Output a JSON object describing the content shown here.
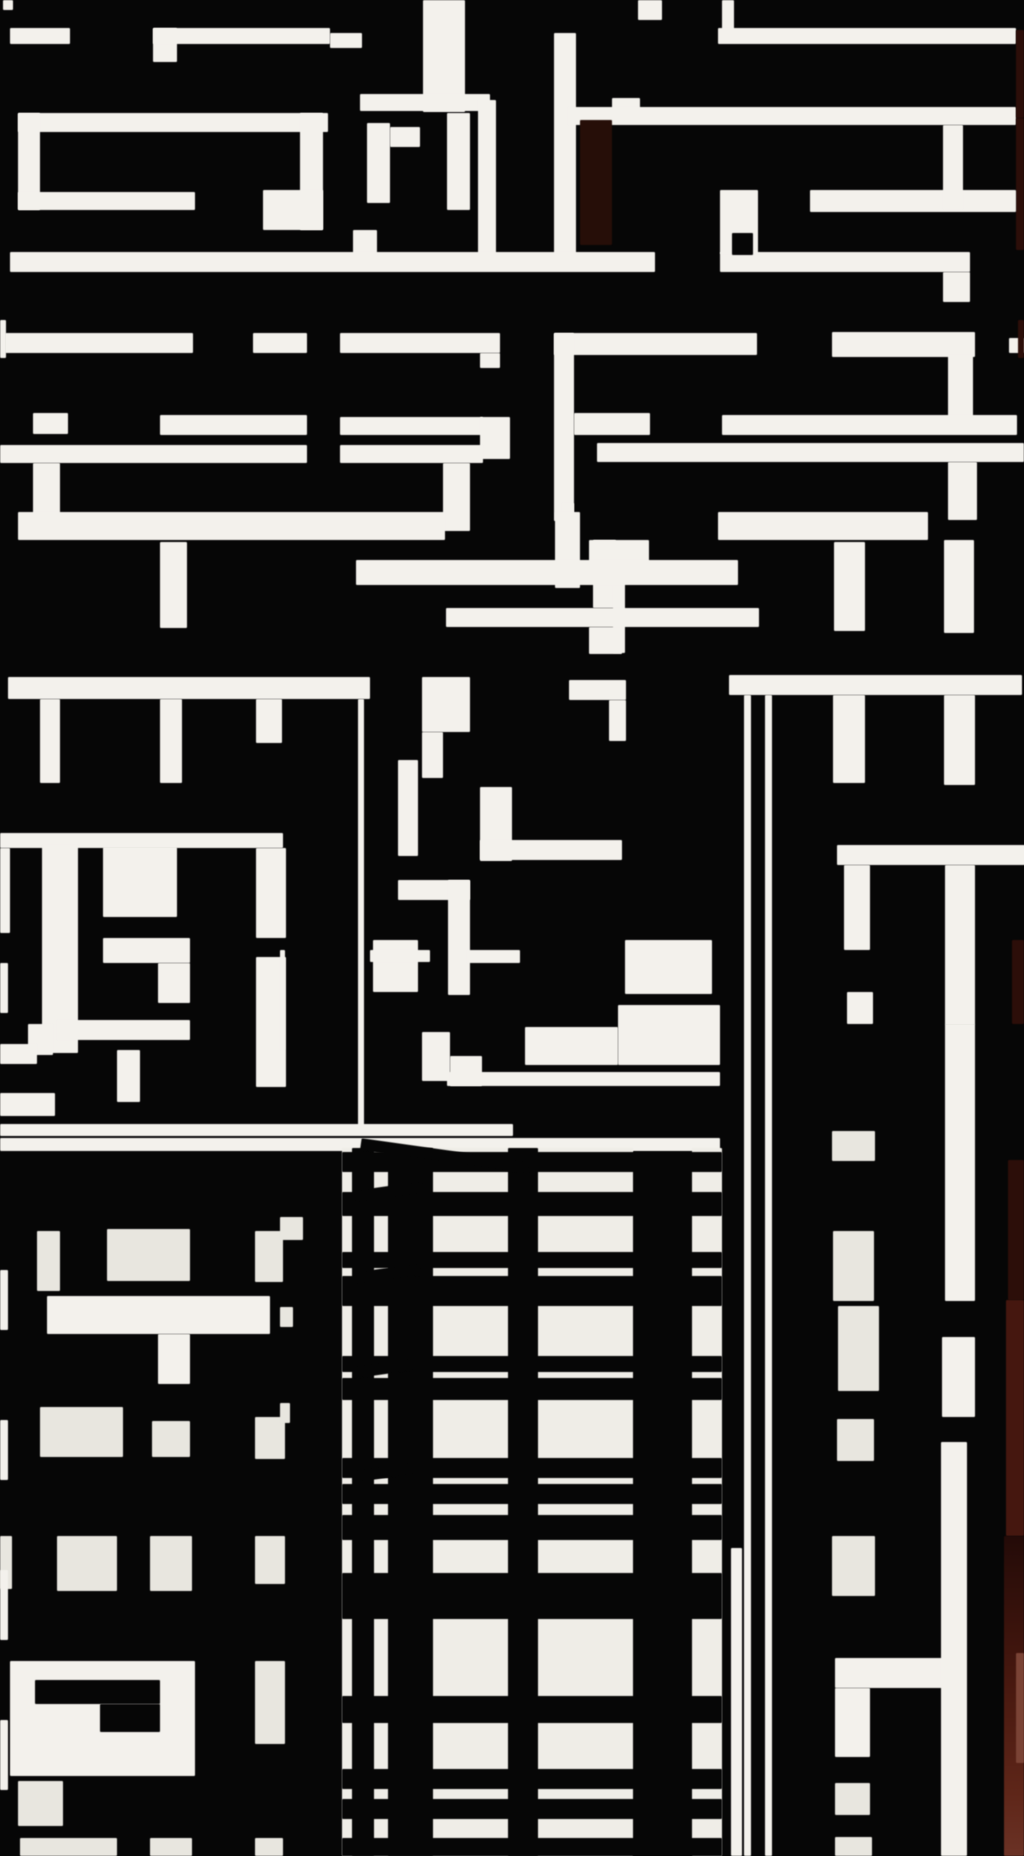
{
  "artwork": {
    "kind": "abstract-monochrome-collage",
    "canvas": {
      "width": 1024,
      "height": 1856
    },
    "palette": {
      "background": "#060606",
      "bar_white": "#f3f1ec",
      "window_white": "#e8e6df",
      "panel_white": "#efede7",
      "maroon": "#260e08",
      "rust_dark": "#2c0e09",
      "rust_mid": "#45170f",
      "rust_bright": "#7a4335"
    },
    "shapes": [
      [
        3,
        0,
        10,
        10,
        "w"
      ],
      [
        10,
        28,
        60,
        16,
        "w"
      ],
      [
        153,
        28,
        24,
        34,
        "w"
      ],
      [
        153,
        28,
        177,
        16,
        "w"
      ],
      [
        330,
        33,
        32,
        15,
        "w"
      ],
      [
        423,
        0,
        42,
        112,
        "w"
      ],
      [
        360,
        94,
        130,
        17,
        "w"
      ],
      [
        554,
        33,
        22,
        222,
        "w"
      ],
      [
        638,
        0,
        24,
        20,
        "w"
      ],
      [
        722,
        0,
        12,
        40,
        "w"
      ],
      [
        718,
        28,
        298,
        16,
        "w"
      ],
      [
        612,
        98,
        28,
        18,
        "w"
      ],
      [
        568,
        107,
        448,
        18,
        "w"
      ],
      [
        478,
        100,
        18,
        160,
        "w"
      ],
      [
        580,
        120,
        32,
        125,
        "m"
      ],
      [
        1016,
        30,
        8,
        88,
        "r1"
      ],
      [
        1016,
        118,
        8,
        132,
        "r1"
      ],
      [
        18,
        113,
        310,
        19,
        "w"
      ],
      [
        18,
        113,
        22,
        97,
        "w"
      ],
      [
        18,
        192,
        177,
        18,
        "w"
      ],
      [
        300,
        113,
        23,
        117,
        "w"
      ],
      [
        263,
        190,
        60,
        40,
        "w"
      ],
      [
        367,
        123,
        23,
        80,
        "w"
      ],
      [
        390,
        127,
        30,
        20,
        "w"
      ],
      [
        447,
        113,
        23,
        97,
        "w"
      ],
      [
        353,
        230,
        24,
        24,
        "w"
      ],
      [
        10,
        252,
        645,
        20,
        "w"
      ],
      [
        720,
        252,
        250,
        20,
        "w"
      ],
      [
        720,
        190,
        38,
        64,
        "w"
      ],
      [
        732,
        233,
        21,
        22,
        "k"
      ],
      [
        810,
        190,
        206,
        22,
        "w"
      ],
      [
        943,
        125,
        20,
        84,
        "w"
      ],
      [
        943,
        272,
        27,
        30,
        "w"
      ],
      [
        0,
        320,
        6,
        38,
        "w"
      ],
      [
        5,
        333,
        188,
        20,
        "w"
      ],
      [
        253,
        333,
        54,
        20,
        "w"
      ],
      [
        340,
        333,
        160,
        20,
        "w"
      ],
      [
        480,
        353,
        20,
        15,
        "w"
      ],
      [
        554,
        333,
        203,
        22,
        "w"
      ],
      [
        554,
        333,
        20,
        188,
        "w"
      ],
      [
        832,
        332,
        143,
        25,
        "w"
      ],
      [
        948,
        355,
        25,
        62,
        "w"
      ],
      [
        1009,
        338,
        15,
        15,
        "w"
      ],
      [
        1018,
        320,
        6,
        38,
        "r1"
      ],
      [
        33,
        413,
        35,
        21,
        "w"
      ],
      [
        160,
        415,
        147,
        20,
        "w"
      ],
      [
        340,
        417,
        143,
        18,
        "w"
      ],
      [
        480,
        417,
        30,
        42,
        "w"
      ],
      [
        574,
        413,
        76,
        22,
        "w"
      ],
      [
        722,
        415,
        295,
        20,
        "w"
      ],
      [
        0,
        445,
        307,
        18,
        "w"
      ],
      [
        340,
        445,
        143,
        18,
        "w"
      ],
      [
        597,
        443,
        427,
        19,
        "w"
      ],
      [
        33,
        463,
        27,
        58,
        "w"
      ],
      [
        443,
        463,
        27,
        68,
        "w"
      ],
      [
        948,
        462,
        29,
        58,
        "w"
      ],
      [
        562,
        503,
        12,
        18,
        "w"
      ],
      [
        18,
        512,
        427,
        28,
        "w"
      ],
      [
        718,
        512,
        210,
        28,
        "w"
      ],
      [
        555,
        512,
        25,
        76,
        "w"
      ],
      [
        593,
        540,
        23,
        68,
        "w"
      ],
      [
        589,
        540,
        60,
        28,
        "w"
      ],
      [
        613,
        569,
        12,
        84,
        "w"
      ],
      [
        589,
        627,
        33,
        27,
        "w"
      ],
      [
        356,
        560,
        382,
        25,
        "w"
      ],
      [
        160,
        542,
        27,
        86,
        "w"
      ],
      [
        446,
        608,
        313,
        19,
        "w"
      ],
      [
        834,
        542,
        31,
        89,
        "w"
      ],
      [
        944,
        540,
        30,
        93,
        "w"
      ],
      [
        8,
        677,
        362,
        22,
        "w"
      ],
      [
        422,
        677,
        48,
        55,
        "w"
      ],
      [
        569,
        680,
        57,
        20,
        "w"
      ],
      [
        729,
        675,
        293,
        20,
        "w"
      ],
      [
        40,
        699,
        20,
        84,
        "w"
      ],
      [
        160,
        699,
        22,
        84,
        "w"
      ],
      [
        256,
        699,
        26,
        44,
        "w"
      ],
      [
        422,
        732,
        21,
        46,
        "w"
      ],
      [
        609,
        700,
        17,
        41,
        "w"
      ],
      [
        833,
        695,
        32,
        88,
        "w"
      ],
      [
        944,
        695,
        31,
        90,
        "w"
      ],
      [
        358,
        699,
        6,
        433,
        "w"
      ],
      [
        744,
        695,
        7,
        1161,
        "w"
      ],
      [
        765,
        695,
        7,
        1161,
        "w"
      ],
      [
        398,
        760,
        20,
        96,
        "w"
      ],
      [
        398,
        880,
        72,
        20,
        "w"
      ],
      [
        448,
        880,
        22,
        115,
        "w"
      ],
      [
        373,
        940,
        45,
        52,
        "w"
      ],
      [
        480,
        787,
        32,
        74,
        "w"
      ],
      [
        0,
        833,
        283,
        15,
        "w"
      ],
      [
        480,
        840,
        142,
        20,
        "w"
      ],
      [
        837,
        845,
        188,
        20,
        "w"
      ],
      [
        0,
        848,
        10,
        85,
        "w"
      ],
      [
        42,
        845,
        36,
        208,
        "w"
      ],
      [
        103,
        847,
        74,
        70,
        "w"
      ],
      [
        103,
        938,
        87,
        25,
        "w"
      ],
      [
        158,
        963,
        32,
        40,
        "w"
      ],
      [
        57,
        1020,
        133,
        20,
        "w"
      ],
      [
        117,
        1050,
        23,
        52,
        "w"
      ],
      [
        0,
        963,
        8,
        50,
        "w"
      ],
      [
        256,
        848,
        30,
        90,
        "w"
      ],
      [
        256,
        957,
        30,
        130,
        "w"
      ],
      [
        844,
        865,
        26,
        85,
        "w"
      ],
      [
        847,
        992,
        26,
        32,
        "w"
      ],
      [
        945,
        865,
        30,
        160,
        "w"
      ],
      [
        625,
        940,
        87,
        54,
        "w"
      ],
      [
        370,
        950,
        60,
        12,
        "w"
      ],
      [
        467,
        950,
        53,
        13,
        "w"
      ],
      [
        618,
        1005,
        102,
        60,
        "w"
      ],
      [
        525,
        1027,
        93,
        38,
        "w"
      ],
      [
        447,
        1072,
        273,
        14,
        "w"
      ],
      [
        422,
        1032,
        28,
        49,
        "w"
      ],
      [
        450,
        1056,
        32,
        30,
        "w"
      ],
      [
        433,
        1140,
        200,
        12,
        "w"
      ],
      [
        28,
        1024,
        25,
        31,
        "w"
      ],
      [
        0,
        1044,
        37,
        20,
        "w"
      ],
      [
        0,
        1093,
        55,
        23,
        "w"
      ],
      [
        280,
        950,
        5,
        100,
        "w"
      ],
      [
        0,
        1124,
        513,
        12,
        "w"
      ],
      [
        0,
        1138,
        720,
        13,
        "w"
      ],
      [
        37,
        1231,
        23,
        60,
        "w2"
      ],
      [
        107,
        1229,
        83,
        52,
        "w2"
      ],
      [
        255,
        1231,
        28,
        51,
        "w2"
      ],
      [
        47,
        1296,
        223,
        38,
        "w"
      ],
      [
        158,
        1334,
        32,
        50,
        "w"
      ],
      [
        40,
        1407,
        83,
        50,
        "w2"
      ],
      [
        152,
        1421,
        38,
        36,
        "w2"
      ],
      [
        255,
        1417,
        30,
        42,
        "w2"
      ],
      [
        0,
        1536,
        12,
        53,
        "w2"
      ],
      [
        57,
        1536,
        60,
        55,
        "w2"
      ],
      [
        150,
        1536,
        42,
        55,
        "w2"
      ],
      [
        255,
        1536,
        30,
        48,
        "w2"
      ],
      [
        10,
        1661,
        185,
        115,
        "w"
      ],
      [
        35,
        1680,
        125,
        24,
        "k"
      ],
      [
        100,
        1704,
        60,
        28,
        "k"
      ],
      [
        255,
        1661,
        30,
        83,
        "w2"
      ],
      [
        18,
        1781,
        45,
        45,
        "w2"
      ],
      [
        20,
        1838,
        97,
        18,
        "w2"
      ],
      [
        150,
        1838,
        42,
        18,
        "w2"
      ],
      [
        255,
        1838,
        28,
        18,
        "w2"
      ],
      [
        0,
        1270,
        8,
        60,
        "w"
      ],
      [
        0,
        1420,
        8,
        60,
        "w"
      ],
      [
        0,
        1570,
        8,
        70,
        "w"
      ],
      [
        0,
        1720,
        8,
        70,
        "w"
      ],
      [
        280,
        1217,
        23,
        23,
        "w2"
      ],
      [
        280,
        1307,
        13,
        20,
        "w2"
      ],
      [
        280,
        1403,
        10,
        20,
        "w2"
      ],
      [
        342,
        1148,
        291,
        708,
        "p"
      ],
      [
        692,
        1148,
        30,
        708,
        "p"
      ],
      [
        352,
        1148,
        22,
        708,
        "k"
      ],
      [
        388,
        1148,
        45,
        708,
        "k"
      ],
      [
        508,
        1148,
        30,
        708,
        "k"
      ],
      [
        342,
        1152,
        380,
        20,
        "k"
      ],
      [
        342,
        1192,
        380,
        24,
        "k"
      ],
      [
        342,
        1252,
        380,
        16,
        "k"
      ],
      [
        342,
        1276,
        380,
        30,
        "k"
      ],
      [
        342,
        1356,
        380,
        16,
        "k"
      ],
      [
        342,
        1378,
        380,
        22,
        "k"
      ],
      [
        342,
        1458,
        380,
        20,
        "k"
      ],
      [
        342,
        1484,
        380,
        20,
        "k"
      ],
      [
        342,
        1515,
        380,
        25,
        "k"
      ],
      [
        342,
        1573,
        380,
        46,
        "k"
      ],
      [
        342,
        1696,
        380,
        27,
        "k"
      ],
      [
        342,
        1769,
        380,
        20,
        "k"
      ],
      [
        342,
        1799,
        380,
        20,
        "k"
      ],
      [
        342,
        1838,
        380,
        18,
        "k"
      ],
      [
        354,
        1186,
        70,
        12,
        "k",
        -8
      ],
      [
        354,
        1268,
        66,
        12,
        "k",
        -8
      ],
      [
        354,
        1362,
        62,
        12,
        "k",
        -8
      ],
      [
        354,
        1466,
        62,
        12,
        "k",
        -8
      ],
      [
        360,
        1150,
        170,
        12,
        "k",
        8
      ],
      [
        731,
        1548,
        11,
        308,
        "w"
      ],
      [
        832,
        1131,
        43,
        30,
        "w2"
      ],
      [
        833,
        1231,
        41,
        70,
        "w2"
      ],
      [
        838,
        1306,
        41,
        85,
        "w2"
      ],
      [
        837,
        1419,
        37,
        42,
        "w2"
      ],
      [
        832,
        1536,
        43,
        60,
        "w2"
      ],
      [
        835,
        1658,
        112,
        30,
        "w"
      ],
      [
        835,
        1688,
        35,
        69,
        "w"
      ],
      [
        835,
        1783,
        35,
        32,
        "w2"
      ],
      [
        835,
        1837,
        37,
        19,
        "w2"
      ],
      [
        945,
        1024,
        30,
        277,
        "w"
      ],
      [
        942,
        1337,
        33,
        80,
        "w"
      ],
      [
        941,
        1442,
        26,
        414,
        "w"
      ],
      [
        1012,
        940,
        12,
        84,
        "r1"
      ],
      [
        1008,
        1160,
        16,
        140,
        "r1"
      ],
      [
        1006,
        1300,
        18,
        236,
        "r2"
      ],
      [
        1004,
        1536,
        20,
        320,
        "rg"
      ],
      [
        1016,
        1653,
        8,
        110,
        "r3"
      ]
    ]
  }
}
